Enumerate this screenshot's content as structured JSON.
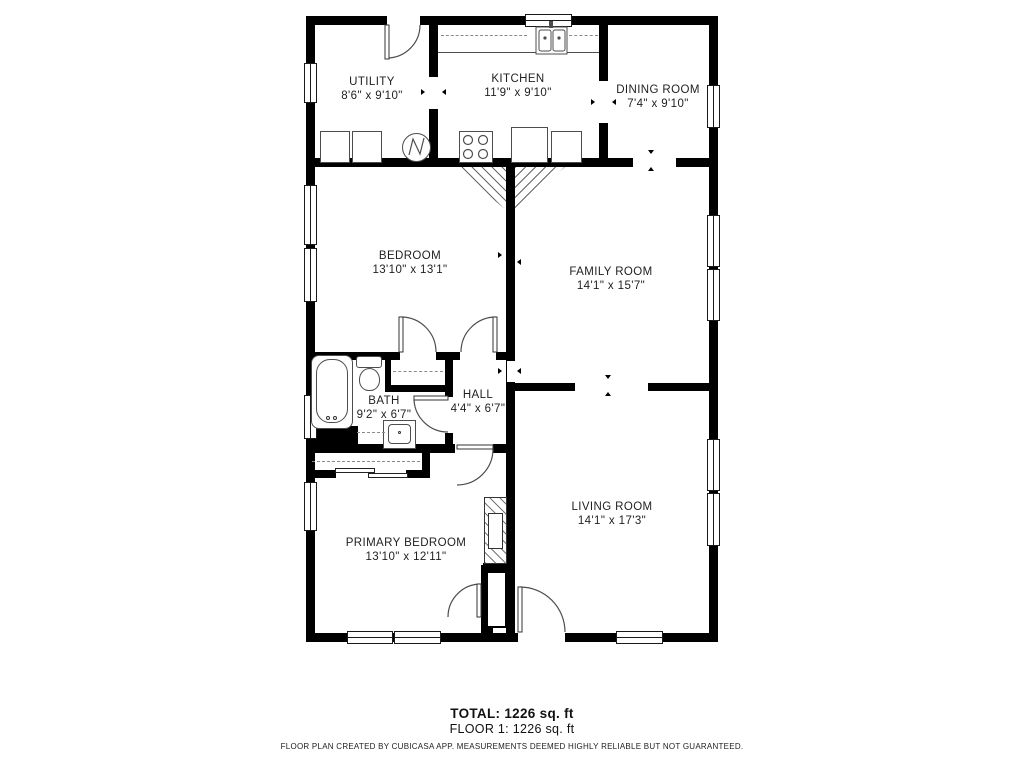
{
  "rooms": [
    {
      "id": "utility",
      "name": "UTILITY",
      "dims": "8'6\" x 9'10\""
    },
    {
      "id": "kitchen",
      "name": "KITCHEN",
      "dims": "11'9\" x 9'10\""
    },
    {
      "id": "dining",
      "name": "DINING ROOM",
      "dims": "7'4\" x 9'10\""
    },
    {
      "id": "bedroom",
      "name": "BEDROOM",
      "dims": "13'10\" x 13'1\""
    },
    {
      "id": "family",
      "name": "FAMILY ROOM",
      "dims": "14'1\" x 15'7\""
    },
    {
      "id": "bath",
      "name": "BATH",
      "dims": "9'2\" x 6'7\""
    },
    {
      "id": "hall",
      "name": "HALL",
      "dims": "4'4\" x 6'7\""
    },
    {
      "id": "primary_bedroom",
      "name": "PRIMARY BEDROOM",
      "dims": "13'10\" x 12'11\""
    },
    {
      "id": "living",
      "name": "LIVING ROOM",
      "dims": "14'1\" x 17'3\""
    }
  ],
  "summary": {
    "total": "TOTAL: 1226 sq. ft",
    "floor_line": "FLOOR 1: 1226 sq. ft"
  },
  "footer": "FLOOR PLAN CREATED BY CUBICASA APP. MEASUREMENTS DEEMED HIGHLY RELIABLE BUT NOT GUARANTEED.",
  "colors": {
    "wall": "#000000",
    "background": "#ffffff",
    "door_stroke": "#4d4d4d"
  }
}
